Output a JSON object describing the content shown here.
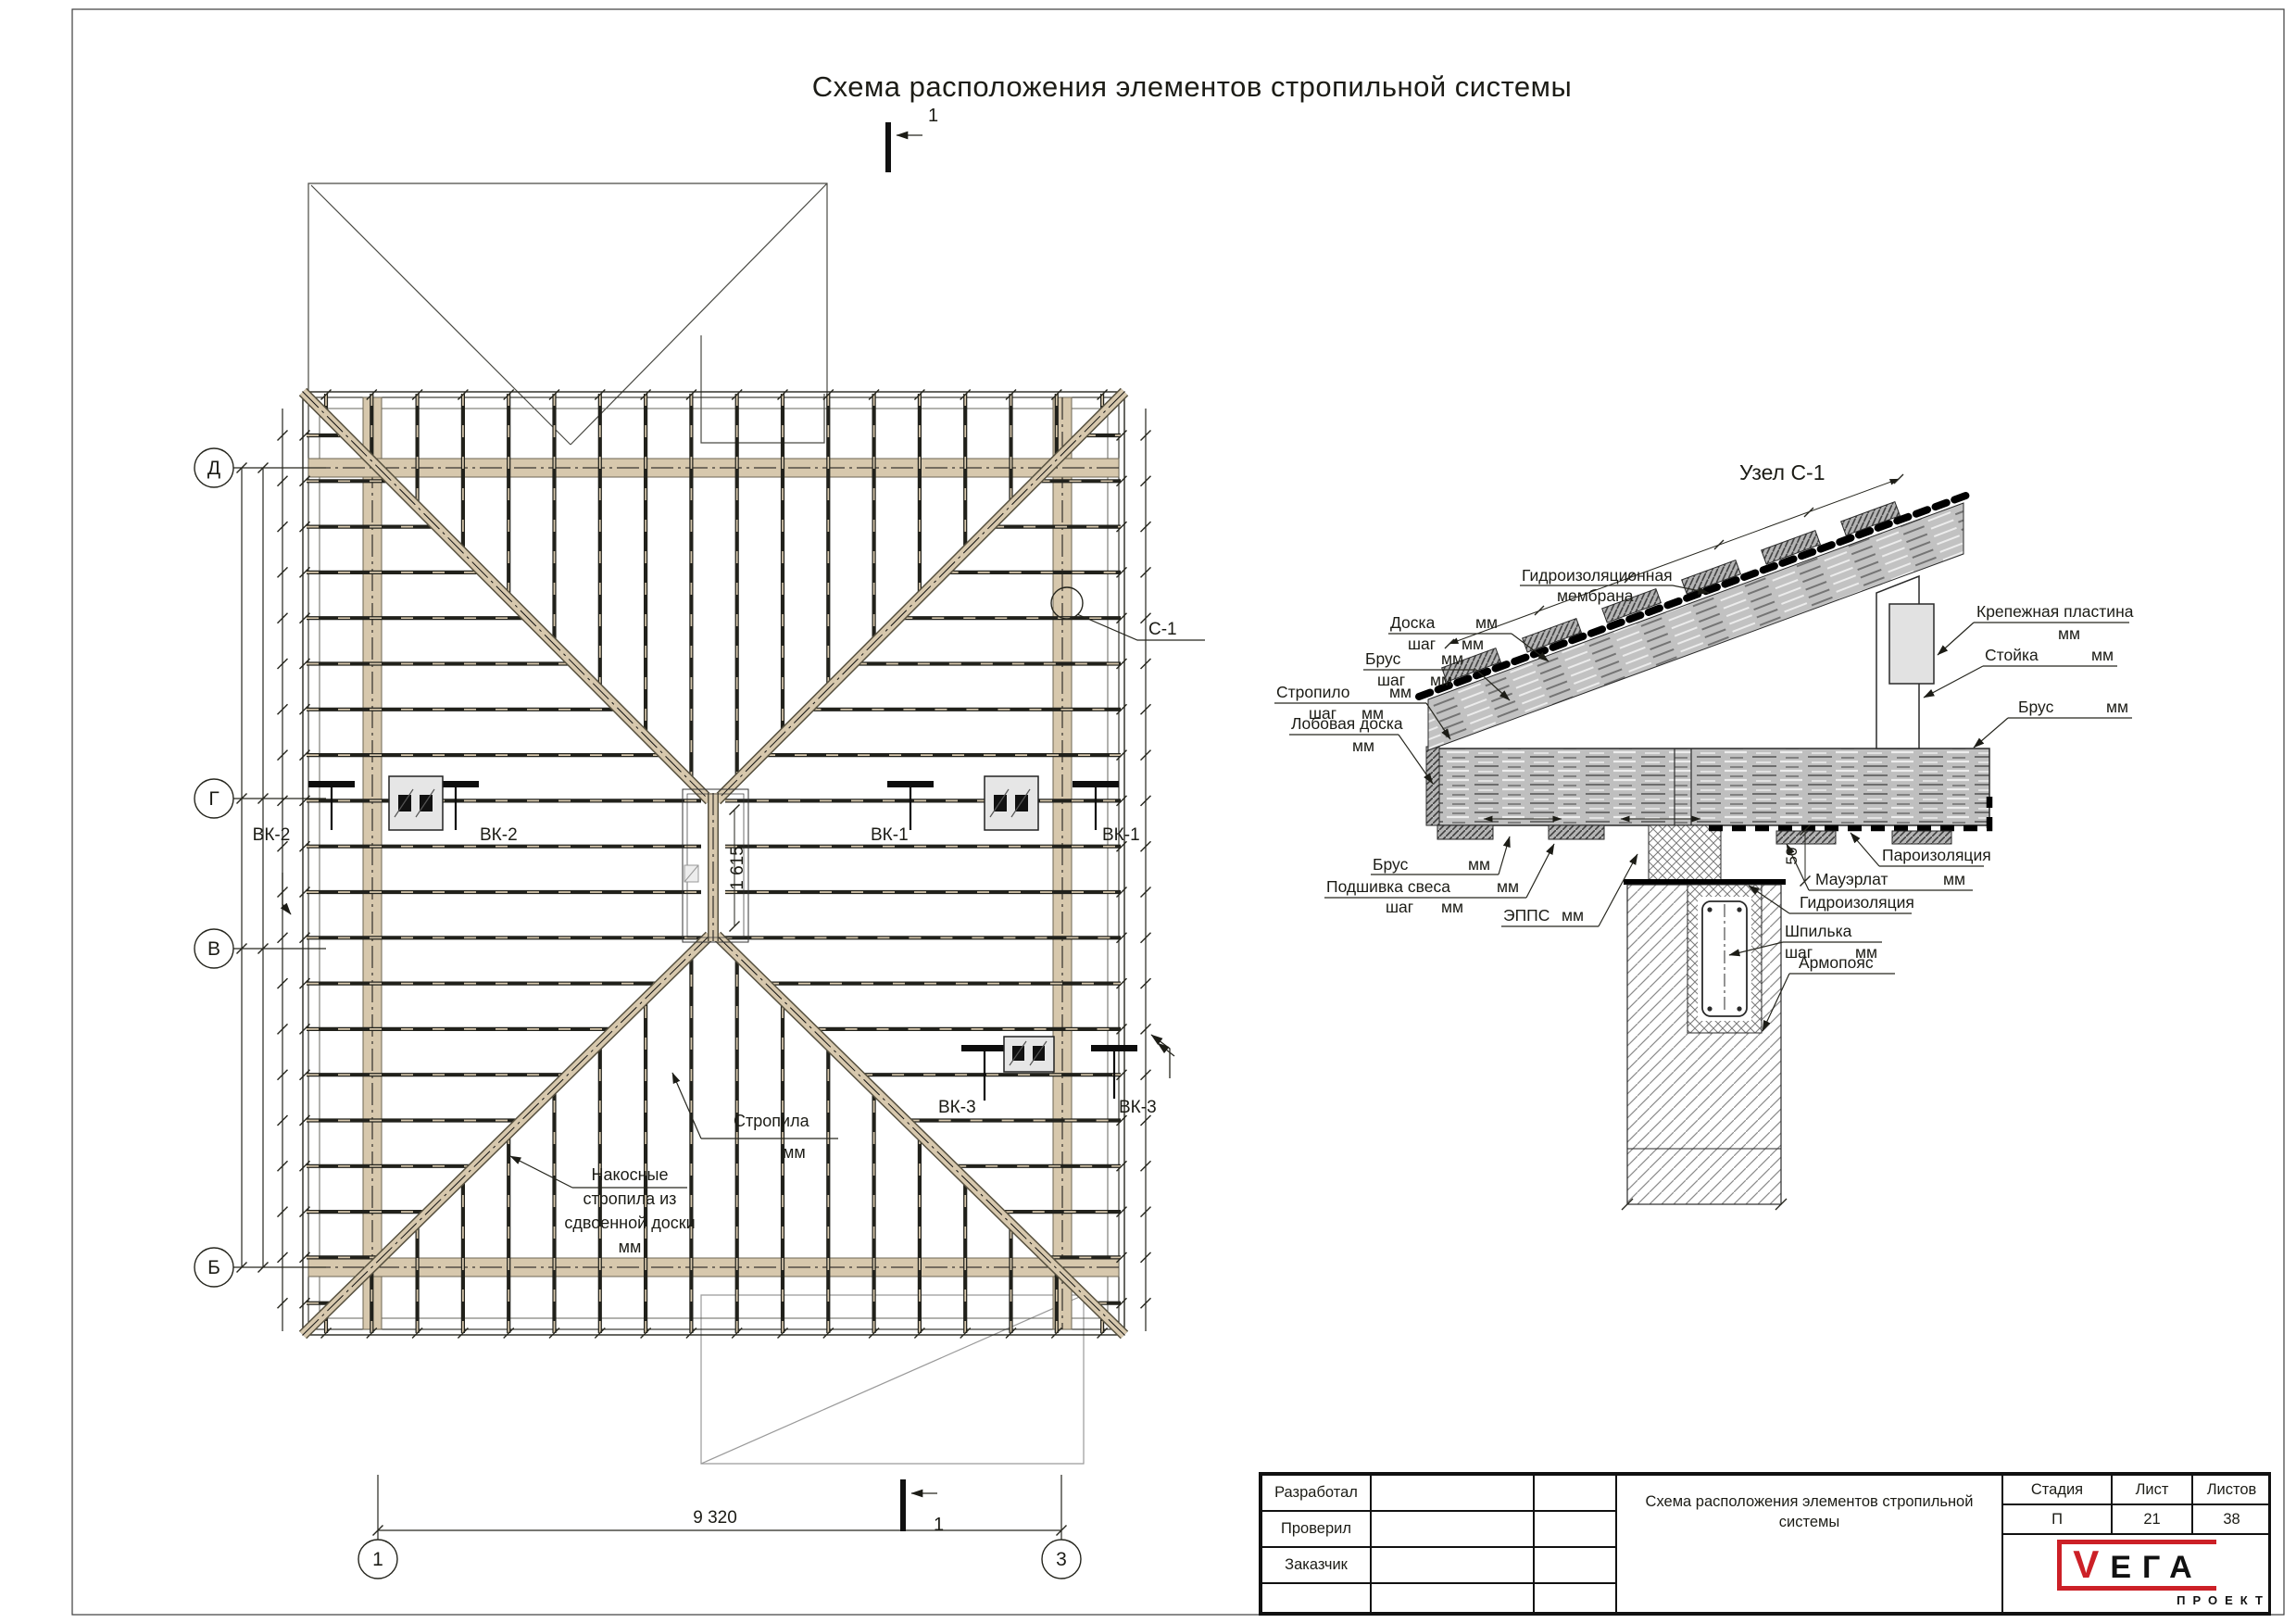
{
  "sheet": {
    "title": "Схема расположения элементов стропильной системы"
  },
  "plan": {
    "section_mark_top": "1",
    "section_mark_bottom": "1",
    "axes_left": [
      "Д",
      "Г",
      "В",
      "Б"
    ],
    "axes_bottom": [
      "1",
      "3"
    ],
    "dim_bottom": "9 320",
    "dim_ridge": "1 615",
    "callout": "С-1",
    "vk": {
      "left2": "ВК-2",
      "mid2": "ВК-2",
      "mid1": "ВК-1",
      "right1": "ВК-1",
      "mid3": "ВК-3",
      "right3": "ВК-3"
    },
    "note_rafters": {
      "text": "Стропила",
      "mm": "мм"
    },
    "note_hip": {
      "l1": "Накосные",
      "l2": "стропила из",
      "l3": "сдвоенной доски",
      "l4": "мм"
    }
  },
  "detail": {
    "title": "Узел С-1",
    "dim_50": "50",
    "labels": {
      "membrane": {
        "l1": "Гидроизоляционная",
        "l2": "мембрана"
      },
      "doska": {
        "name": "Доска",
        "mm": "мм",
        "sub": "шаг",
        "sub_mm": "мм"
      },
      "brus_top": {
        "name": "Брус",
        "mm": "мм",
        "sub": "шаг",
        "sub_mm": "мм"
      },
      "stropilo": {
        "name": "Стропило",
        "mm": "мм",
        "sub": "шаг",
        "sub_mm": "мм"
      },
      "lobovaya": {
        "name": "Лобовая доска",
        "mm": "мм"
      },
      "krep": {
        "name": "Крепежная пластина",
        "mm": "мм"
      },
      "stoyka": {
        "name": "Стойка",
        "mm": "мм"
      },
      "brus_right": {
        "name": "Брус",
        "mm": "мм"
      },
      "brus_bottom": {
        "name": "Брус",
        "mm": "мм"
      },
      "podshivka": {
        "name": "Подшивка свеса",
        "mm": "мм",
        "sub": "шаг",
        "sub_mm": "мм"
      },
      "epps": {
        "name": "ЭППС",
        "mm": "мм"
      },
      "paro": "Пароизоляция",
      "mauerlat": {
        "name": "Мауэрлат",
        "mm": "мм"
      },
      "gidro": "Гидроизоляция",
      "shpilka": {
        "name": "Шпилька",
        "sub": "шаг",
        "sub_mm": "мм"
      },
      "armopoyas": "Армопояс"
    }
  },
  "titleblock": {
    "rows": [
      "Разработал",
      "Проверил",
      "Заказчик"
    ],
    "doc_title": "Схема расположения элементов стропильной системы",
    "stage_label": "Стадия",
    "sheet_label": "Лист",
    "sheets_label": "Листов",
    "stage": "П",
    "sheet": "21",
    "sheets": "38",
    "logo": {
      "v": "V",
      "ega": "ЕГА",
      "sub": "ПРОЕКТ"
    },
    "accent_color": "#cc2027"
  }
}
